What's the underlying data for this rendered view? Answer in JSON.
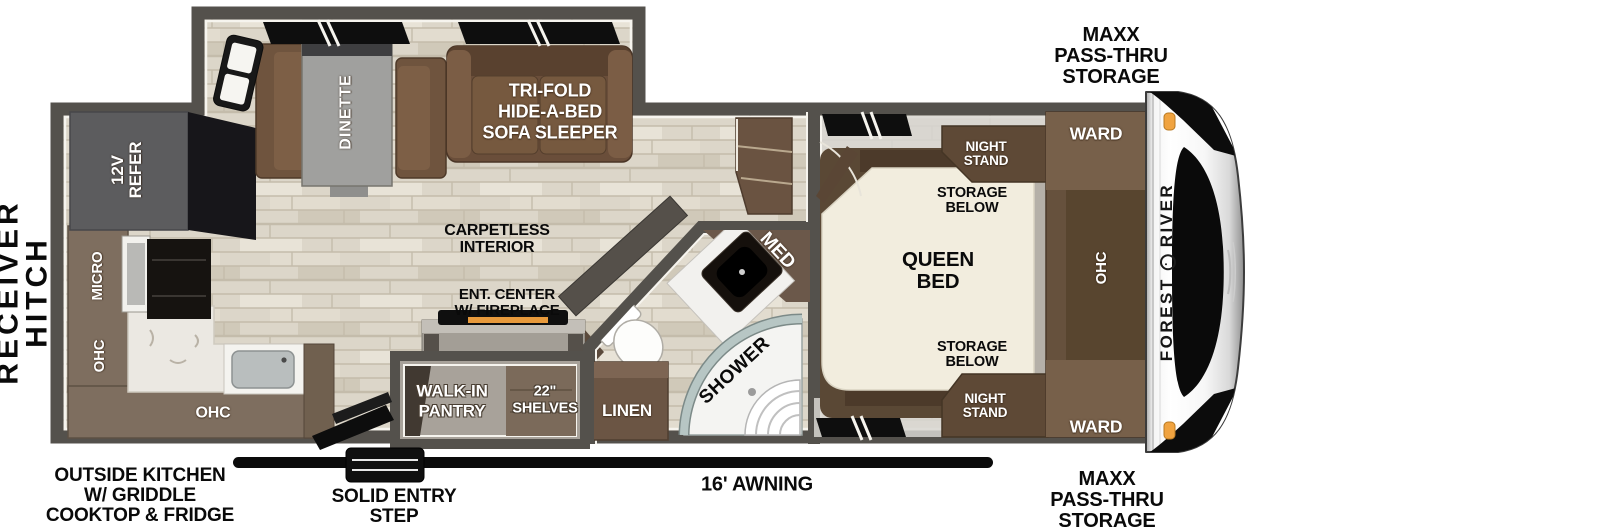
{
  "floorplan": {
    "exterior_labels": {
      "receiver_hitch": [
        "RECEIVER",
        "HITCH"
      ],
      "maxx_pass_thru_top": [
        "MAXX",
        "PASS-THRU",
        "STORAGE"
      ],
      "maxx_pass_thru_bottom": [
        "MAXX",
        "PASS-THRU",
        "STORAGE"
      ],
      "outside_kitchen": [
        "OUTSIDE KITCHEN",
        "W/ GRIDDLE",
        "COOKTOP & FRIDGE"
      ],
      "solid_entry_step": [
        "SOLID ENTRY",
        "STEP"
      ],
      "awning": "16' AWNING"
    },
    "living_area": {
      "dinette": "DINETTE",
      "sofa": [
        "TRI-FOLD",
        "HIDE-A-BED",
        "SOFA SLEEPER"
      ],
      "carpetless": [
        "CARPETLESS",
        "INTERIOR"
      ],
      "ent_center": [
        "ENT. CENTER",
        "W/ FIREPLACE"
      ]
    },
    "kitchen": {
      "refer": [
        "12V",
        "REFER"
      ],
      "micro": "MICRO",
      "ohc_wall": "OHC",
      "ohc_lower": "OHC"
    },
    "pantry": {
      "name": [
        "WALK-IN",
        "PANTRY"
      ],
      "shelves": [
        "22\"",
        "SHELVES"
      ]
    },
    "bathroom": {
      "linen": "LINEN",
      "shower": "SHOWER",
      "med": "MED"
    },
    "bedroom": {
      "night_stand_top": [
        "NIGHT",
        "STAND"
      ],
      "night_stand_bottom": [
        "NIGHT",
        "STAND"
      ],
      "storage_below_top": [
        "STORAGE",
        "BELOW"
      ],
      "storage_below_bottom": [
        "STORAGE",
        "BELOW"
      ],
      "queen_bed": [
        "QUEEN",
        "BED"
      ],
      "ward_top": "WARD",
      "ward_bottom": "WARD",
      "ohc": "OHC"
    },
    "front_cap": {
      "brand_first": "FOREST",
      "brand_second": "RIVER"
    },
    "colors": {
      "wall": "#54514c",
      "floor": "#dcd6c9",
      "furniture_brown": "#6a4e3a",
      "cabinet_brown": "#7e6e5f",
      "marker_orange": "#f0a340",
      "awning_black": "#0b0b0b"
    }
  }
}
